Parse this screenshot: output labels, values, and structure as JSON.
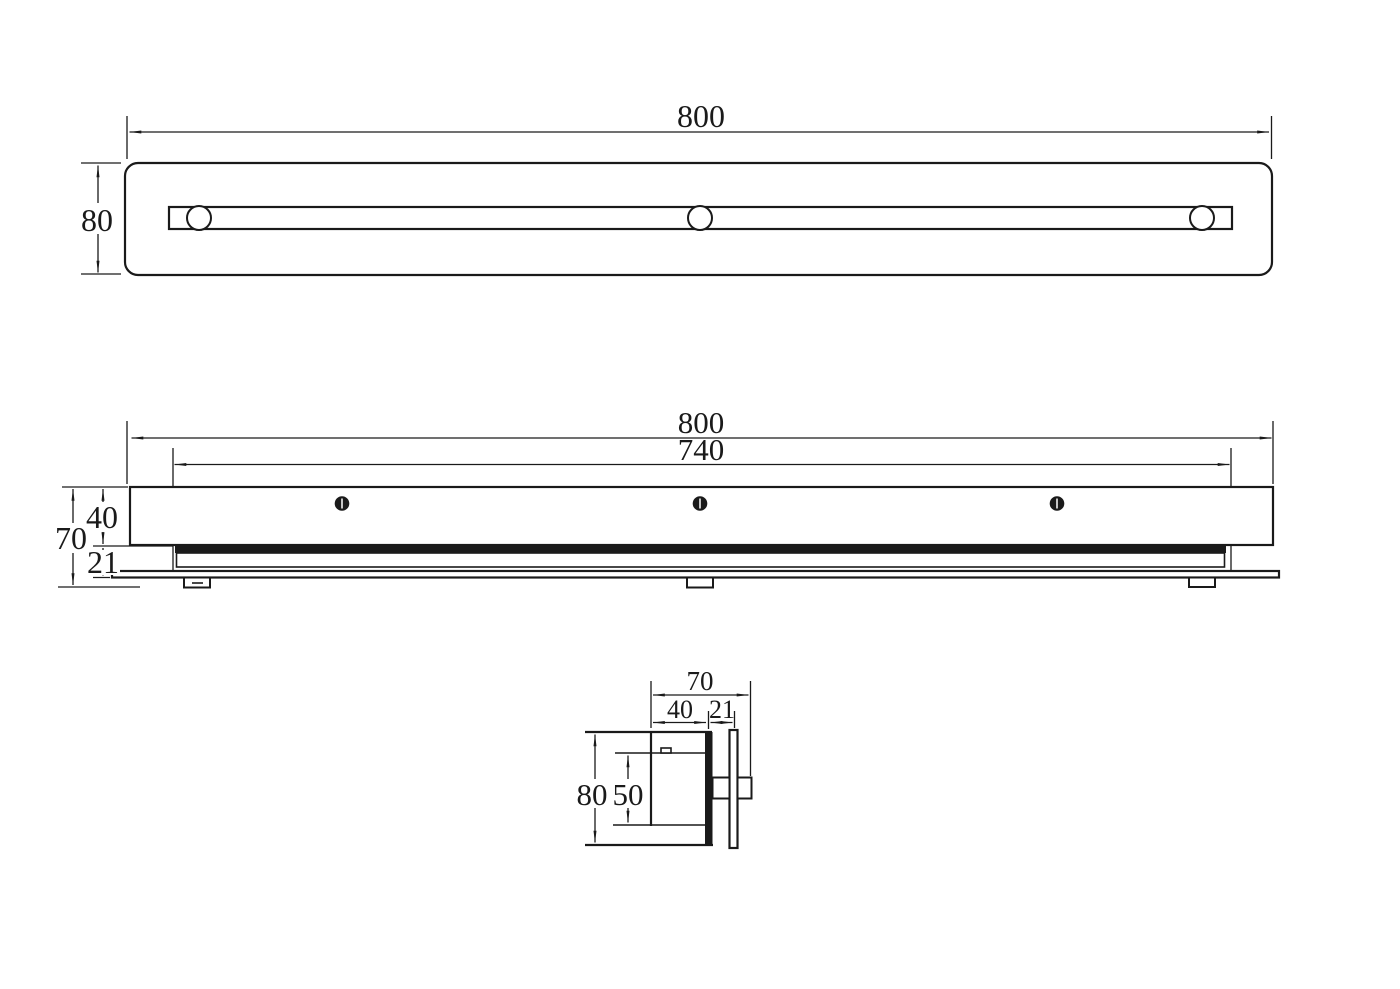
{
  "colors": {
    "background": "#ffffff",
    "line": "#1a1a1a"
  },
  "views": {
    "top": {
      "dims": {
        "width": "800",
        "height": "80"
      }
    },
    "front": {
      "dims": {
        "width": "800",
        "inner_width": "740",
        "total_height": "70",
        "body_height": "40",
        "base_height": "21"
      }
    },
    "section": {
      "dims": {
        "width": "70",
        "body_width": "40",
        "flange_width": "21",
        "height": "80",
        "inner_height": "50"
      }
    }
  }
}
